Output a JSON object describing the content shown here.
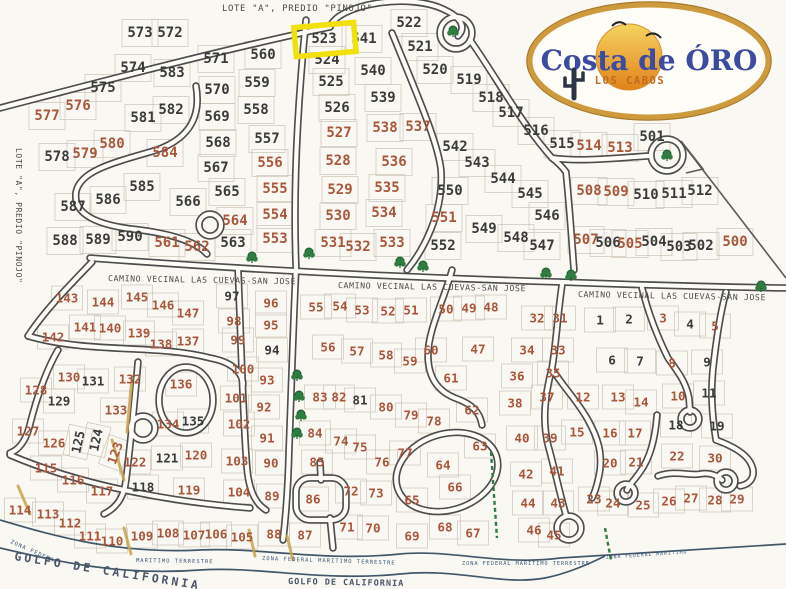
{
  "titles": {
    "top": "LOTE \"A\", PREDIO \"PINOJO\"",
    "left_vertical": "LOTE \"A\", PREDIO \"PINOJO\""
  },
  "logo": {
    "line1": "Costa de ÓRO",
    "line2": "LOS CABOS"
  },
  "highlight": {
    "lot": "523",
    "color": "#f2e00a"
  },
  "colors": {
    "lot_orange": "#a9573b",
    "lot_black": "#3b3b3b",
    "road_outline": "#4d4d4d",
    "road_fill": "#fdfcf8",
    "tree_green": "#2f7d3f",
    "coast_blue": "#41586b",
    "logo_gold": "#cd9b3e",
    "logo_blue": "#3b4ba0",
    "logo_text_orange": "#bf6a1f",
    "sun_top": "#f6d35f",
    "sun_bottom": "#e0831c",
    "sand": "#c8a44e"
  },
  "road_labels": [
    {
      "text": "CAMINO VECINAL LAS CUEVAS-SAN JOSE",
      "x": 108,
      "y": 281,
      "rot": 1
    },
    {
      "text": "CAMINO VECINAL LAS CUEVAS-SAN JOSE",
      "x": 338,
      "y": 288,
      "rot": 1
    },
    {
      "text": "CAMINO VECINAL LAS CUEVAS-SAN JOSE",
      "x": 578,
      "y": 297,
      "rot": 1
    }
  ],
  "zona_labels": [
    {
      "text": "ZONA FEDERAL",
      "x": 10,
      "y": 543,
      "rot": 24,
      "size": 5.5
    },
    {
      "text": "MARITIMO TERRESTRE",
      "x": 136,
      "y": 562,
      "rot": 1,
      "size": 5.5
    },
    {
      "text": "ZONA FEDERAL MARITIMO TERRESTRE",
      "x": 262,
      "y": 560,
      "rot": 2,
      "size": 5.5
    },
    {
      "text": "ZONA FEDERAL MARITIMO TERRESTRE",
      "x": 462,
      "y": 565,
      "rot": 0,
      "size": 5.2
    },
    {
      "text": "ZONA FEDERAL MARITIMO",
      "x": 606,
      "y": 559,
      "rot": -4,
      "size": 4.8
    }
  ],
  "sea_labels": [
    {
      "text": "GOLFO DE CALIFORNIA",
      "x": 14,
      "y": 560,
      "rot": 9,
      "size": 11.5,
      "spacing": 3
    },
    {
      "text": "GOLFO DE CALIFORNIA",
      "x": 288,
      "y": 584,
      "rot": 1,
      "size": 8.5,
      "spacing": 1
    }
  ],
  "trees": [
    [
      453,
      31
    ],
    [
      667,
      155
    ],
    [
      252,
      257
    ],
    [
      309,
      253
    ],
    [
      400,
      262
    ],
    [
      423,
      266
    ],
    [
      546,
      273
    ],
    [
      571,
      275
    ],
    [
      761,
      286
    ],
    [
      297,
      375
    ],
    [
      299,
      396
    ],
    [
      301,
      415
    ],
    [
      297,
      433
    ]
  ],
  "lots": [
    [
      "573",
      140,
      33,
      "k"
    ],
    [
      "572",
      170,
      33,
      "k"
    ],
    [
      "571",
      216,
      59,
      "k"
    ],
    [
      "560",
      263,
      55,
      "k"
    ],
    [
      "559",
      257,
      83,
      "k"
    ],
    [
      "558",
      256,
      110,
      "k"
    ],
    [
      "557",
      267,
      139,
      "k"
    ],
    [
      "556",
      270,
      163,
      "o"
    ],
    [
      "555",
      275,
      189,
      "o"
    ],
    [
      "554",
      275,
      215,
      "o"
    ],
    [
      "553",
      275,
      239,
      "o"
    ],
    [
      "574",
      133,
      68,
      "k"
    ],
    [
      "583",
      172,
      73,
      "k"
    ],
    [
      "575",
      103,
      88,
      "k"
    ],
    [
      "576",
      78,
      106,
      "o"
    ],
    [
      "577",
      47,
      116,
      "o"
    ],
    [
      "581",
      143,
      118,
      "k"
    ],
    [
      "582",
      171,
      110,
      "k"
    ],
    [
      "578",
      57,
      157,
      "k"
    ],
    [
      "579",
      85,
      154,
      "o"
    ],
    [
      "580",
      112,
      144,
      "o"
    ],
    [
      "584",
      165,
      153,
      "o"
    ],
    [
      "570",
      217,
      90,
      "k"
    ],
    [
      "569",
      217,
      117,
      "k"
    ],
    [
      "568",
      218,
      143,
      "k"
    ],
    [
      "567",
      216,
      168,
      "k"
    ],
    [
      "565",
      227,
      192,
      "k"
    ],
    [
      "566",
      188,
      202,
      "k"
    ],
    [
      "564",
      235,
      221,
      "o"
    ],
    [
      "563",
      233,
      243,
      "k"
    ],
    [
      "562",
      197,
      247,
      "o"
    ],
    [
      "561",
      167,
      243,
      "o"
    ],
    [
      "585",
      142,
      187,
      "k"
    ],
    [
      "586",
      108,
      200,
      "k"
    ],
    [
      "587",
      73,
      207,
      "k"
    ],
    [
      "588",
      65,
      241,
      "k"
    ],
    [
      "589",
      98,
      240,
      "k"
    ],
    [
      "590",
      130,
      237,
      "k"
    ],
    [
      "523",
      324,
      39,
      "k"
    ],
    [
      "541",
      364,
      39,
      "k"
    ],
    [
      "522",
      409,
      23,
      "k"
    ],
    [
      "521",
      420,
      47,
      "k"
    ],
    [
      "520",
      435,
      70,
      "k"
    ],
    [
      "519",
      469,
      80,
      "k"
    ],
    [
      "518",
      491,
      98,
      "k"
    ],
    [
      "517",
      511,
      113,
      "k"
    ],
    [
      "516",
      536,
      131,
      "k"
    ],
    [
      "515",
      562,
      144,
      "k"
    ],
    [
      "514",
      589,
      146,
      "o"
    ],
    [
      "513",
      620,
      148,
      "o"
    ],
    [
      "501",
      652,
      137,
      "k"
    ],
    [
      "524",
      327,
      60,
      "k"
    ],
    [
      "525",
      331,
      82,
      "k"
    ],
    [
      "526",
      337,
      108,
      "k"
    ],
    [
      "540",
      373,
      71,
      "k"
    ],
    [
      "539",
      383,
      98,
      "k"
    ],
    [
      "538",
      385,
      128,
      "o"
    ],
    [
      "537",
      418,
      127,
      "o"
    ],
    [
      "527",
      339,
      133,
      "o"
    ],
    [
      "528",
      338,
      161,
      "o"
    ],
    [
      "529",
      340,
      190,
      "o"
    ],
    [
      "530",
      338,
      216,
      "o"
    ],
    [
      "531",
      333,
      243,
      "o"
    ],
    [
      "532",
      358,
      247,
      "o"
    ],
    [
      "533",
      392,
      243,
      "o"
    ],
    [
      "536",
      394,
      162,
      "o"
    ],
    [
      "535",
      387,
      188,
      "o"
    ],
    [
      "534",
      384,
      213,
      "o"
    ],
    [
      "542",
      455,
      147,
      "k"
    ],
    [
      "543",
      477,
      163,
      "k"
    ],
    [
      "544",
      503,
      179,
      "k"
    ],
    [
      "550",
      450,
      191,
      "k"
    ],
    [
      "551",
      444,
      218,
      "o"
    ],
    [
      "549",
      484,
      229,
      "k"
    ],
    [
      "548",
      516,
      238,
      "k"
    ],
    [
      "552",
      443,
      246,
      "k"
    ],
    [
      "545",
      530,
      194,
      "k"
    ],
    [
      "546",
      547,
      216,
      "k"
    ],
    [
      "547",
      542,
      246,
      "k"
    ],
    [
      "508",
      589,
      191,
      "o"
    ],
    [
      "509",
      616,
      192,
      "o"
    ],
    [
      "510",
      646,
      195,
      "k"
    ],
    [
      "511",
      674,
      194,
      "k"
    ],
    [
      "512",
      700,
      191,
      "k"
    ],
    [
      "507",
      586,
      240,
      "o"
    ],
    [
      "506",
      608,
      243,
      "k"
    ],
    [
      "505",
      630,
      244,
      "o"
    ],
    [
      "504",
      654,
      242,
      "k"
    ],
    [
      "503",
      679,
      247,
      "k"
    ],
    [
      "502",
      701,
      246,
      "k"
    ],
    [
      "500",
      735,
      242,
      "o"
    ],
    [
      "143",
      67,
      298,
      "o"
    ],
    [
      "144",
      103,
      302,
      "o"
    ],
    [
      "145",
      137,
      297,
      "o"
    ],
    [
      "146",
      163,
      305,
      "o"
    ],
    [
      "147",
      188,
      313,
      "o"
    ],
    [
      "142",
      53,
      337,
      "o"
    ],
    [
      "141",
      85,
      327,
      "o"
    ],
    [
      "140",
      110,
      328,
      "o"
    ],
    [
      "139",
      139,
      333,
      "o"
    ],
    [
      "138",
      161,
      344,
      "o"
    ],
    [
      "137",
      188,
      341,
      "o"
    ],
    [
      "97",
      232,
      296,
      "k"
    ],
    [
      "98",
      234,
      321,
      "o"
    ],
    [
      "99",
      238,
      340,
      "o"
    ],
    [
      "100",
      243,
      369,
      "o"
    ],
    [
      "101",
      236,
      398,
      "o"
    ],
    [
      "102",
      239,
      424,
      "o"
    ],
    [
      "103",
      237,
      461,
      "o"
    ],
    [
      "104",
      239,
      492,
      "o"
    ],
    [
      "130",
      69,
      377,
      "o"
    ],
    [
      "131",
      93,
      381,
      "k"
    ],
    [
      "132",
      130,
      379,
      "o"
    ],
    [
      "136",
      181,
      384,
      "o"
    ],
    [
      "128",
      36,
      390,
      "o"
    ],
    [
      "129",
      59,
      401,
      "k"
    ],
    [
      "133",
      116,
      410,
      "o"
    ],
    [
      "134",
      168,
      424,
      "o"
    ],
    [
      "135",
      193,
      421,
      "k"
    ],
    [
      "127",
      28,
      431,
      "o"
    ],
    [
      "126",
      54,
      443,
      "o"
    ],
    [
      "125",
      78,
      442,
      "k",
      -78
    ],
    [
      "124",
      96,
      440,
      "k",
      -78
    ],
    [
      "123",
      115,
      453,
      "o",
      -70
    ],
    [
      "115",
      46,
      468,
      "o"
    ],
    [
      "116",
      73,
      480,
      "o"
    ],
    [
      "117",
      102,
      491,
      "o"
    ],
    [
      "122",
      135,
      462,
      "o"
    ],
    [
      "121",
      167,
      458,
      "k"
    ],
    [
      "120",
      196,
      455,
      "o"
    ],
    [
      "118",
      143,
      487,
      "k"
    ],
    [
      "119",
      189,
      490,
      "o"
    ],
    [
      "114",
      20,
      510,
      "o"
    ],
    [
      "113",
      48,
      514,
      "o"
    ],
    [
      "112",
      70,
      523,
      "o"
    ],
    [
      "111",
      90,
      536,
      "o"
    ],
    [
      "110",
      112,
      541,
      "o"
    ],
    [
      "109",
      142,
      536,
      "o"
    ],
    [
      "108",
      168,
      533,
      "o"
    ],
    [
      "107",
      194,
      535,
      "o"
    ],
    [
      "106",
      216,
      534,
      "o"
    ],
    [
      "105",
      242,
      537,
      "o"
    ],
    [
      "96",
      271,
      303,
      "o"
    ],
    [
      "95",
      271,
      325,
      "o"
    ],
    [
      "94",
      272,
      350,
      "k"
    ],
    [
      "93",
      267,
      380,
      "o"
    ],
    [
      "92",
      264,
      407,
      "o"
    ],
    [
      "91",
      267,
      438,
      "o"
    ],
    [
      "90",
      271,
      463,
      "o"
    ],
    [
      "89",
      272,
      496,
      "o"
    ],
    [
      "88",
      274,
      534,
      "o"
    ],
    [
      "87",
      305,
      535,
      "o"
    ],
    [
      "55",
      316,
      307,
      "o"
    ],
    [
      "54",
      340,
      306,
      "o"
    ],
    [
      "53",
      362,
      310,
      "o"
    ],
    [
      "52",
      388,
      311,
      "o"
    ],
    [
      "51",
      411,
      310,
      "o"
    ],
    [
      "50",
      446,
      309,
      "o"
    ],
    [
      "49",
      469,
      308,
      "o"
    ],
    [
      "48",
      491,
      307,
      "o"
    ],
    [
      "56",
      328,
      347,
      "o"
    ],
    [
      "57",
      357,
      351,
      "o"
    ],
    [
      "58",
      386,
      355,
      "o"
    ],
    [
      "59",
      410,
      361,
      "o"
    ],
    [
      "60",
      431,
      350,
      "o"
    ],
    [
      "47",
      478,
      349,
      "o"
    ],
    [
      "61",
      451,
      378,
      "o"
    ],
    [
      "62",
      472,
      410,
      "o"
    ],
    [
      "83",
      320,
      397,
      "o"
    ],
    [
      "82",
      339,
      397,
      "o"
    ],
    [
      "81",
      360,
      400,
      "k"
    ],
    [
      "80",
      386,
      407,
      "o"
    ],
    [
      "79",
      411,
      415,
      "o"
    ],
    [
      "78",
      434,
      421,
      "o"
    ],
    [
      "84",
      315,
      433,
      "o"
    ],
    [
      "85",
      317,
      462,
      "o"
    ],
    [
      "86",
      313,
      499,
      "o"
    ],
    [
      "74",
      341,
      441,
      "o"
    ],
    [
      "75",
      360,
      447,
      "o"
    ],
    [
      "76",
      382,
      462,
      "o"
    ],
    [
      "77",
      405,
      453,
      "o"
    ],
    [
      "72",
      351,
      491,
      "o"
    ],
    [
      "73",
      376,
      493,
      "o"
    ],
    [
      "71",
      347,
      527,
      "o"
    ],
    [
      "70",
      373,
      528,
      "o"
    ],
    [
      "65",
      412,
      500,
      "o"
    ],
    [
      "64",
      443,
      465,
      "o"
    ],
    [
      "66",
      455,
      487,
      "o"
    ],
    [
      "63",
      480,
      446,
      "o"
    ],
    [
      "69",
      412,
      536,
      "o"
    ],
    [
      "68",
      445,
      527,
      "o"
    ],
    [
      "67",
      473,
      533,
      "o"
    ],
    [
      "32",
      537,
      318,
      "o"
    ],
    [
      "31",
      560,
      318,
      "o"
    ],
    [
      "34",
      527,
      350,
      "o"
    ],
    [
      "33",
      558,
      350,
      "o"
    ],
    [
      "36",
      517,
      376,
      "o"
    ],
    [
      "35",
      553,
      373,
      "o"
    ],
    [
      "38",
      515,
      403,
      "o"
    ],
    [
      "37",
      547,
      397,
      "o"
    ],
    [
      "40",
      522,
      438,
      "o"
    ],
    [
      "39",
      550,
      438,
      "o"
    ],
    [
      "42",
      526,
      474,
      "o"
    ],
    [
      "41",
      557,
      471,
      "o"
    ],
    [
      "44",
      528,
      503,
      "o"
    ],
    [
      "43",
      558,
      503,
      "o"
    ],
    [
      "46",
      534,
      530,
      "o"
    ],
    [
      "45",
      554,
      535,
      "o"
    ],
    [
      "1",
      600,
      320,
      "k"
    ],
    [
      "2",
      629,
      319,
      "k"
    ],
    [
      "3",
      663,
      318,
      "o"
    ],
    [
      "4",
      690,
      324,
      "k"
    ],
    [
      "5",
      715,
      326,
      "o"
    ],
    [
      "6",
      612,
      360,
      "k"
    ],
    [
      "7",
      640,
      361,
      "k"
    ],
    [
      "8",
      672,
      363,
      "o"
    ],
    [
      "9",
      707,
      362,
      "k"
    ],
    [
      "10",
      678,
      396,
      "o"
    ],
    [
      "11",
      709,
      393,
      "k"
    ],
    [
      "12",
      583,
      397,
      "o"
    ],
    [
      "13",
      618,
      397,
      "o"
    ],
    [
      "14",
      641,
      402,
      "o"
    ],
    [
      "15",
      577,
      432,
      "o"
    ],
    [
      "16",
      610,
      433,
      "o"
    ],
    [
      "17",
      635,
      433,
      "o"
    ],
    [
      "18",
      676,
      425,
      "k"
    ],
    [
      "19",
      717,
      426,
      "k"
    ],
    [
      "20",
      610,
      463,
      "o"
    ],
    [
      "21",
      636,
      462,
      "o"
    ],
    [
      "22",
      677,
      456,
      "o"
    ],
    [
      "30",
      715,
      458,
      "o"
    ],
    [
      "23",
      594,
      499,
      "o"
    ],
    [
      "24",
      613,
      503,
      "o"
    ],
    [
      "25",
      643,
      505,
      "o"
    ],
    [
      "26",
      669,
      501,
      "o"
    ],
    [
      "27",
      691,
      498,
      "o"
    ],
    [
      "28",
      715,
      500,
      "o"
    ],
    [
      "29",
      737,
      499,
      "o"
    ]
  ]
}
